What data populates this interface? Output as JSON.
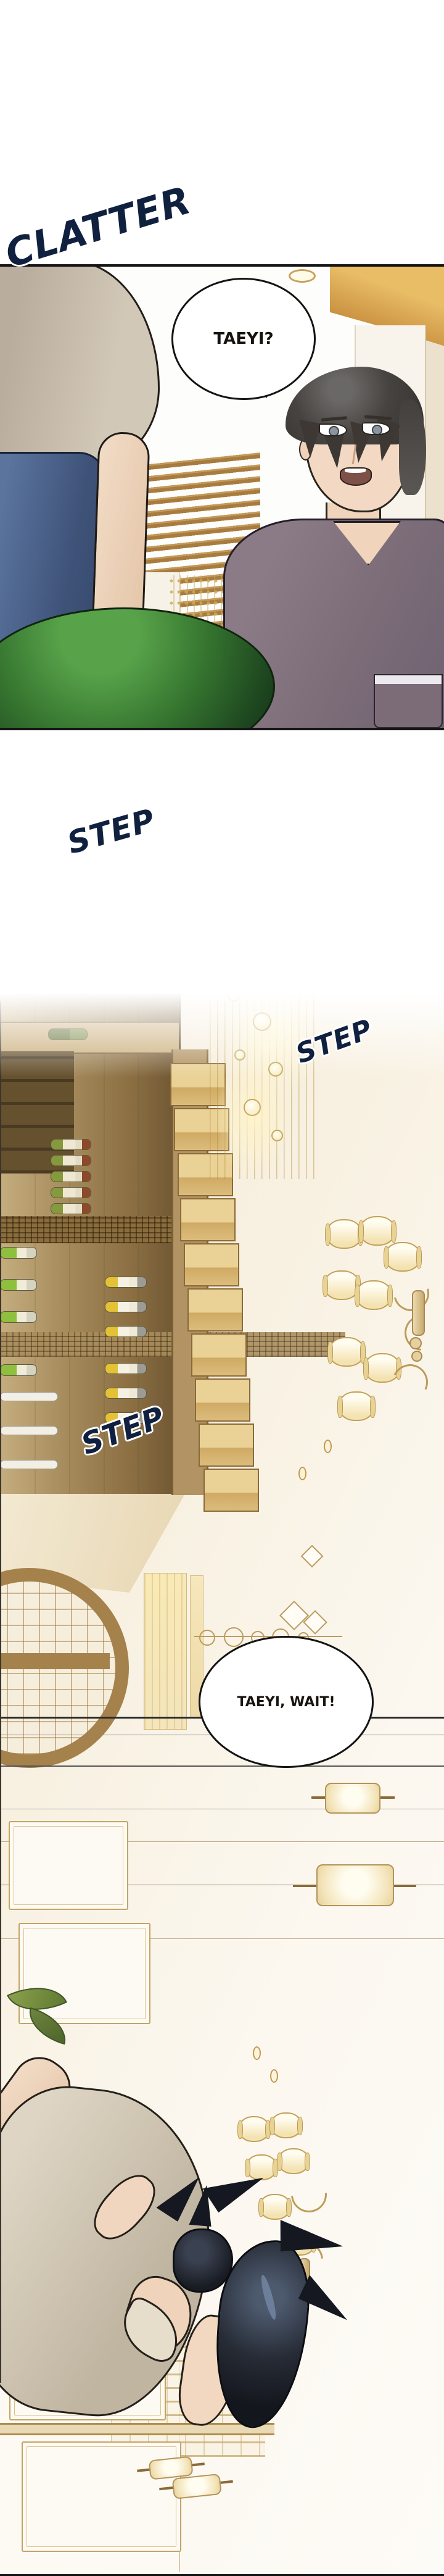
{
  "page_type": "webtoon-comic-page",
  "sfx": {
    "clatter": "CLATTER",
    "step1": "STEP",
    "step2": "STEP",
    "step3": "STEP"
  },
  "speech": {
    "bubble1": "TAEYI?",
    "bubble2": "TAEYI, WAIT!"
  },
  "colors": {
    "sfx_navy": "#10203f",
    "outline_black": "#141414",
    "accent_gold": "#c6a25f",
    "wood_brown": "#a8895a",
    "lamp_cream": "#f7ecce",
    "skin": "#f0d6bf",
    "hair_dark": "#1b1f27",
    "man_shirt_mauve": "#7b6c78",
    "taeyi_shirt_beige": "#c9bfae",
    "jeans_blue": "#43597e",
    "sphere_green": "#2f6b2f",
    "wall_cream": "#f6efe3"
  }
}
